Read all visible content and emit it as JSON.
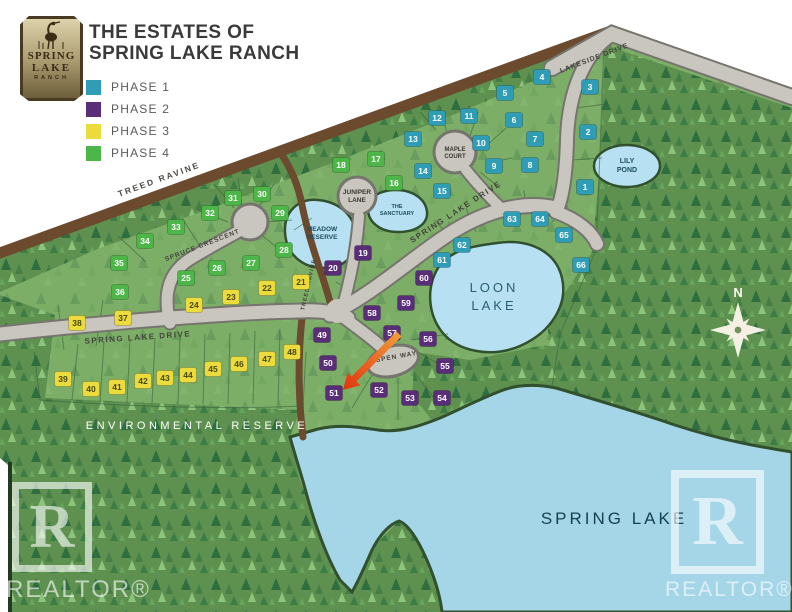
{
  "header": {
    "title_line1": "THE ESTATES OF",
    "title_line2": "SPRING LAKE RANCH",
    "legend": [
      {
        "label": "PHASE 1",
        "color": "#2f9db6"
      },
      {
        "label": "PHASE 2",
        "color": "#5a2d79"
      },
      {
        "label": "PHASE 3",
        "color": "#ecdb3d"
      },
      {
        "label": "PHASE 4",
        "color": "#4cb648"
      }
    ]
  },
  "logo": {
    "line1": "SPRING",
    "line2": "LAKE",
    "line3": "RANCH"
  },
  "watermark": {
    "letter": "R",
    "text": "REALTOR®"
  },
  "map": {
    "labels": {
      "treed_ravine": "TREED RAVINE",
      "treed_ravine_vertical": "TREED RAVINE",
      "lakeside_drive": "LAKESIDE DRIVE",
      "spruce_crescent": "SPRUCE CRESCENT",
      "spring_lake_drive_west": "SPRING LAKE DRIVE",
      "spring_lake_drive_ne": "SPRING LAKE DRIVE",
      "maple_court_1": "MAPLE",
      "maple_court_2": "COURT",
      "juniper_lane_1": "JUNIPER",
      "juniper_lane_2": "LANE",
      "aspen_way": "ASPEN WAY",
      "meadow_reserve_1": "MEADOW",
      "meadow_reserve_2": "RESERVE",
      "sanctuary_1": "THE",
      "sanctuary_2": "SANCTUARY",
      "lily_pond_1": "LILY",
      "lily_pond_2": "POND",
      "loon_lake_1": "LOON",
      "loon_lake_2": "LAKE",
      "spring_lake": "SPRING LAKE",
      "environmental_reserve": "ENVIRONMENTAL RESERVE",
      "compass_n": "N"
    },
    "phase_colors": {
      "1": "#2f9db6",
      "2": "#5a2d79",
      "3": "#ecdb3d",
      "4": "#4cb648"
    },
    "lots": [
      {
        "n": 1,
        "phase": 1,
        "x": 585,
        "y": 187
      },
      {
        "n": 2,
        "phase": 1,
        "x": 588,
        "y": 132
      },
      {
        "n": 3,
        "phase": 1,
        "x": 590,
        "y": 87
      },
      {
        "n": 4,
        "phase": 1,
        "x": 542,
        "y": 77
      },
      {
        "n": 5,
        "phase": 1,
        "x": 505,
        "y": 93
      },
      {
        "n": 6,
        "phase": 1,
        "x": 514,
        "y": 120
      },
      {
        "n": 7,
        "phase": 1,
        "x": 535,
        "y": 139
      },
      {
        "n": 8,
        "phase": 1,
        "x": 530,
        "y": 165
      },
      {
        "n": 9,
        "phase": 1,
        "x": 494,
        "y": 166
      },
      {
        "n": 10,
        "phase": 1,
        "x": 481,
        "y": 143
      },
      {
        "n": 11,
        "phase": 1,
        "x": 469,
        "y": 116
      },
      {
        "n": 12,
        "phase": 1,
        "x": 437,
        "y": 118
      },
      {
        "n": 13,
        "phase": 1,
        "x": 413,
        "y": 139
      },
      {
        "n": 14,
        "phase": 1,
        "x": 423,
        "y": 171
      },
      {
        "n": 15,
        "phase": 1,
        "x": 442,
        "y": 191
      },
      {
        "n": 16,
        "phase": 4,
        "x": 394,
        "y": 183
      },
      {
        "n": 17,
        "phase": 4,
        "x": 376,
        "y": 159
      },
      {
        "n": 18,
        "phase": 4,
        "x": 341,
        "y": 165
      },
      {
        "n": 19,
        "phase": 2,
        "x": 363,
        "y": 253
      },
      {
        "n": 20,
        "phase": 2,
        "x": 333,
        "y": 268
      },
      {
        "n": 21,
        "phase": 3,
        "x": 301,
        "y": 282
      },
      {
        "n": 22,
        "phase": 3,
        "x": 267,
        "y": 288
      },
      {
        "n": 23,
        "phase": 3,
        "x": 231,
        "y": 297
      },
      {
        "n": 24,
        "phase": 3,
        "x": 194,
        "y": 305
      },
      {
        "n": 25,
        "phase": 4,
        "x": 186,
        "y": 278
      },
      {
        "n": 26,
        "phase": 4,
        "x": 217,
        "y": 268
      },
      {
        "n": 27,
        "phase": 4,
        "x": 251,
        "y": 263
      },
      {
        "n": 28,
        "phase": 4,
        "x": 284,
        "y": 250
      },
      {
        "n": 29,
        "phase": 4,
        "x": 280,
        "y": 213
      },
      {
        "n": 30,
        "phase": 4,
        "x": 262,
        "y": 194
      },
      {
        "n": 31,
        "phase": 4,
        "x": 233,
        "y": 198
      },
      {
        "n": 32,
        "phase": 4,
        "x": 210,
        "y": 213
      },
      {
        "n": 33,
        "phase": 4,
        "x": 176,
        "y": 227
      },
      {
        "n": 34,
        "phase": 4,
        "x": 145,
        "y": 241
      },
      {
        "n": 35,
        "phase": 4,
        "x": 119,
        "y": 263
      },
      {
        "n": 36,
        "phase": 4,
        "x": 120,
        "y": 292
      },
      {
        "n": 37,
        "phase": 3,
        "x": 123,
        "y": 318
      },
      {
        "n": 38,
        "phase": 3,
        "x": 77,
        "y": 323
      },
      {
        "n": 39,
        "phase": 3,
        "x": 63,
        "y": 379
      },
      {
        "n": 40,
        "phase": 3,
        "x": 91,
        "y": 389
      },
      {
        "n": 41,
        "phase": 3,
        "x": 117,
        "y": 387
      },
      {
        "n": 42,
        "phase": 3,
        "x": 143,
        "y": 381
      },
      {
        "n": 43,
        "phase": 3,
        "x": 165,
        "y": 378
      },
      {
        "n": 44,
        "phase": 3,
        "x": 188,
        "y": 375
      },
      {
        "n": 45,
        "phase": 3,
        "x": 213,
        "y": 369
      },
      {
        "n": 46,
        "phase": 3,
        "x": 239,
        "y": 364
      },
      {
        "n": 47,
        "phase": 3,
        "x": 267,
        "y": 359
      },
      {
        "n": 48,
        "phase": 3,
        "x": 292,
        "y": 352
      },
      {
        "n": 49,
        "phase": 2,
        "x": 322,
        "y": 335
      },
      {
        "n": 50,
        "phase": 2,
        "x": 328,
        "y": 363
      },
      {
        "n": 51,
        "phase": 2,
        "x": 334,
        "y": 393
      },
      {
        "n": 52,
        "phase": 2,
        "x": 379,
        "y": 390
      },
      {
        "n": 53,
        "phase": 2,
        "x": 410,
        "y": 398
      },
      {
        "n": 54,
        "phase": 2,
        "x": 442,
        "y": 398
      },
      {
        "n": 55,
        "phase": 2,
        "x": 445,
        "y": 366
      },
      {
        "n": 56,
        "phase": 2,
        "x": 428,
        "y": 339
      },
      {
        "n": 57,
        "phase": 2,
        "x": 392,
        "y": 333
      },
      {
        "n": 58,
        "phase": 2,
        "x": 372,
        "y": 313
      },
      {
        "n": 59,
        "phase": 2,
        "x": 406,
        "y": 303
      },
      {
        "n": 60,
        "phase": 2,
        "x": 424,
        "y": 278
      },
      {
        "n": 61,
        "phase": 1,
        "x": 442,
        "y": 260
      },
      {
        "n": 62,
        "phase": 1,
        "x": 462,
        "y": 245
      },
      {
        "n": 63,
        "phase": 1,
        "x": 512,
        "y": 219
      },
      {
        "n": 64,
        "phase": 1,
        "x": 540,
        "y": 219
      },
      {
        "n": 65,
        "phase": 1,
        "x": 564,
        "y": 235
      },
      {
        "n": 66,
        "phase": 1,
        "x": 581,
        "y": 265
      }
    ]
  }
}
